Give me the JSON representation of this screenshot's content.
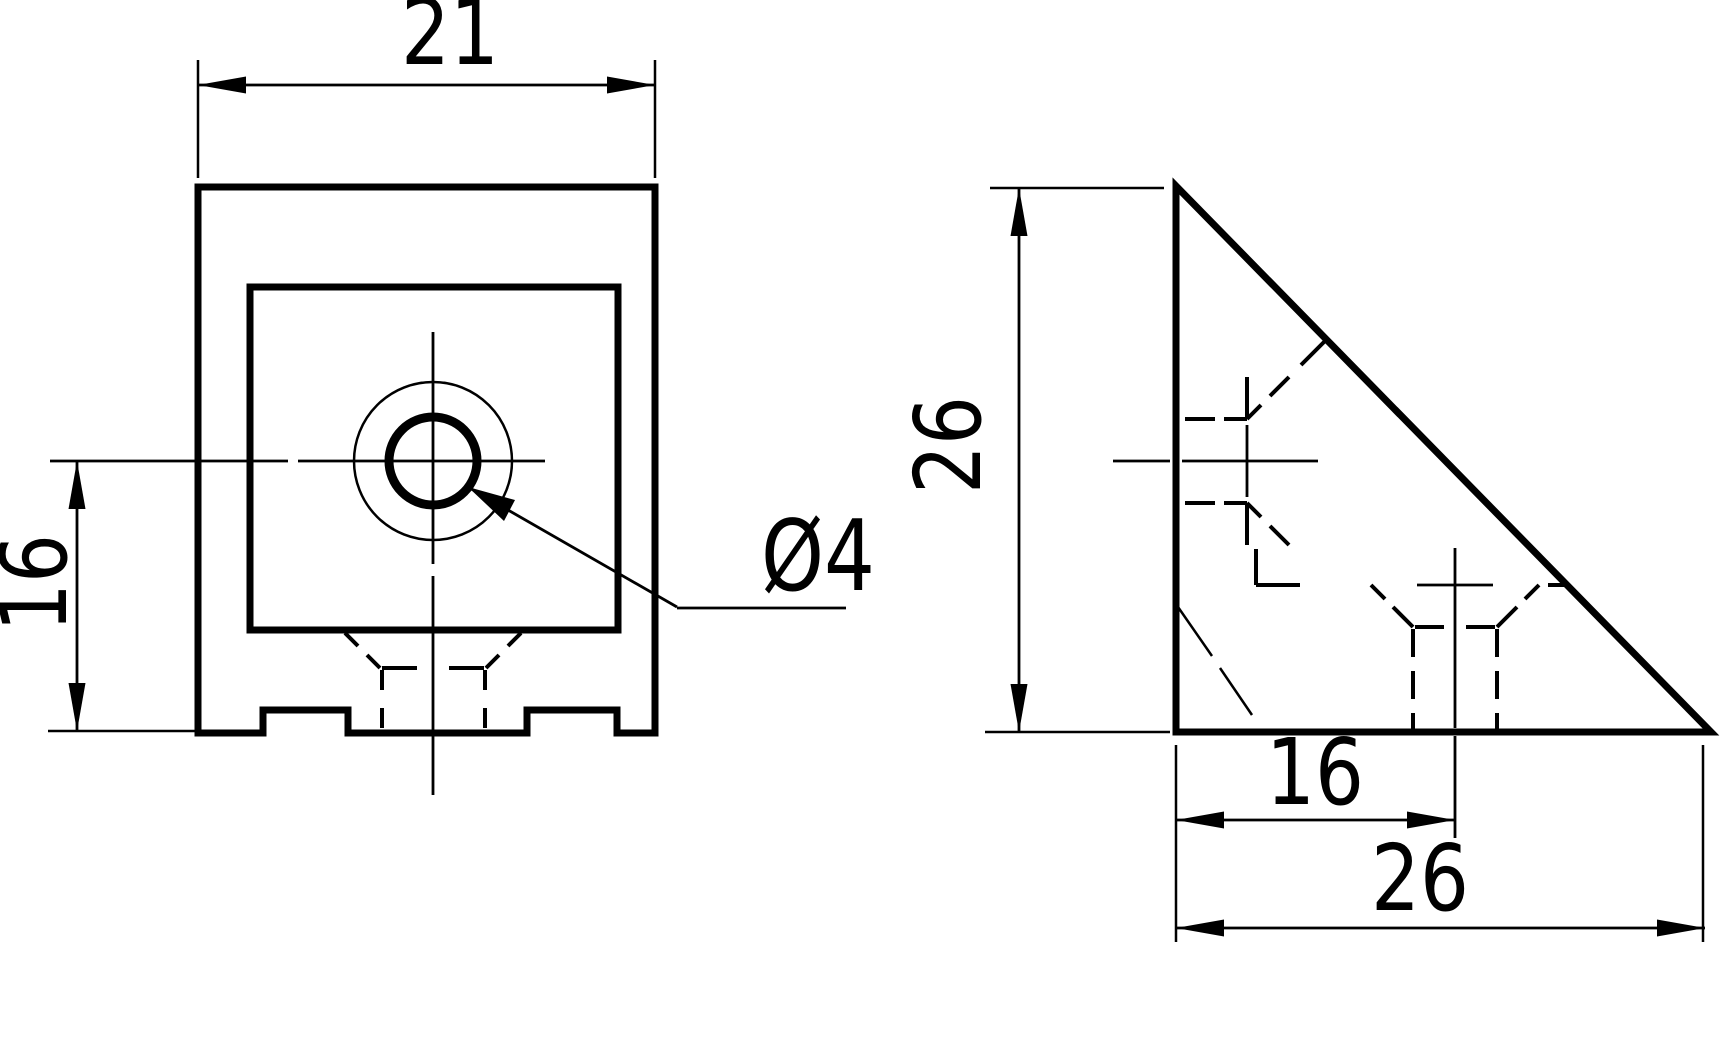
{
  "colors": {
    "background": "#ffffff",
    "line": "#000000"
  },
  "drawing": {
    "type": "technical-2d-orthographic",
    "front_view": {
      "description": "front view of corner bracket with counterbored hole and notched base",
      "dims": {
        "width_label": "21",
        "height_label": "16",
        "hole_label": "Ø4"
      }
    },
    "side_view": {
      "description": "side view right triangle with hidden hole lines",
      "dims": {
        "height_label": "26",
        "hole_offset_label": "16",
        "base_label": "26"
      }
    }
  }
}
